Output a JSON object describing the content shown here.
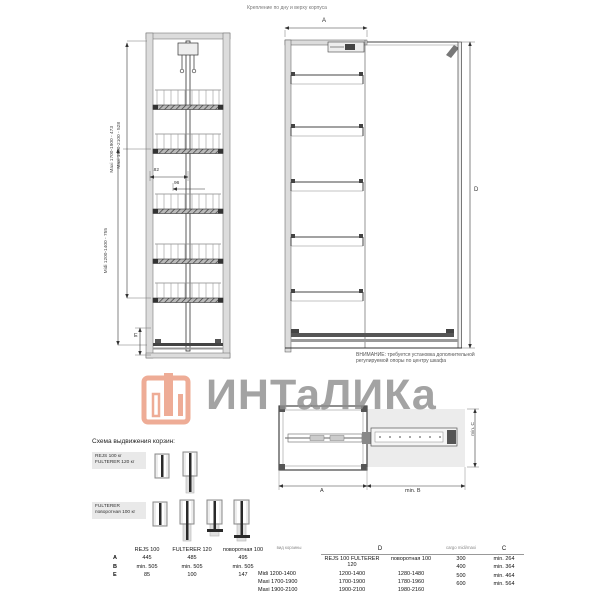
{
  "top_note": "Крепление по дну и верху корпуса",
  "watermark": {
    "brand": "ИНТаЛИКа"
  },
  "front_view": {
    "dim_maxi_upper": "Maxi 1700-1900 - 473",
    "dim_maxi_lower": "Maxi 1900-2100 - 528",
    "dim_midi": "Midi 1200-1400 - 755",
    "dim_width": "182",
    "dim_inner": "96",
    "dim_e_label": "E"
  },
  "side_view": {
    "dim_a_label": "A",
    "dim_d_label": "D",
    "note_line1": "ВНИМАНИЕ: требуется установка дополнительной",
    "note_line2": "регулируемой опоры по центру шкафа"
  },
  "plan_view": {
    "dim_a_label": "A",
    "dim_b_label": "min. B",
    "dim_c_label": "min. C"
  },
  "schema": {
    "title": "Схема выдвижения корзин:",
    "group1_line1": "REJS 100 кг",
    "group1_line2": "FULTERER 120 кг",
    "group2_line1": "FULTERER",
    "group2_line2": "поворотная 100 кг"
  },
  "table_abe": {
    "col_headers": [
      "REJS 100",
      "FULTERER 120",
      "поворотная 100"
    ],
    "rows": [
      {
        "label": "A",
        "c1": "445",
        "c2": "485",
        "c3": "495"
      },
      {
        "label": "B",
        "c1": "min. 505",
        "c2": "min. 505",
        "c3": "min. 505"
      },
      {
        "label": "E",
        "c1": "85",
        "c2": "100",
        "c3": "147"
      }
    ]
  },
  "table_d": {
    "corner_header": "вид корзины",
    "span_header": "D",
    "col1_header": "REJS 100  FULTERER 120",
    "col2_header": "поворотная 100",
    "rows": [
      {
        "label": "Midi 1200-1400",
        "c1": "1200-1400",
        "c2": "1280-1480"
      },
      {
        "label": "Maxi 1700-1900",
        "c1": "1700-1900",
        "c2": "1780-1960"
      },
      {
        "label": "Maxi 1900-2100",
        "c1": "1900-2100",
        "c2": "1980-2160"
      }
    ]
  },
  "table_c": {
    "corner_header": "cargo midi/maxi",
    "col_header": "C",
    "rows": [
      {
        "label": "300",
        "value": "min. 264"
      },
      {
        "label": "400",
        "value": "min. 364"
      },
      {
        "label": "500",
        "value": "min. 464"
      },
      {
        "label": "600",
        "value": "min. 564"
      }
    ]
  },
  "colors": {
    "accent": "#eb9b80",
    "watermark_text": "#8f8f8f",
    "line": "#3a3a3a",
    "wall_fill": "#dcdcdc",
    "shade_fill": "#e6e6e6"
  }
}
